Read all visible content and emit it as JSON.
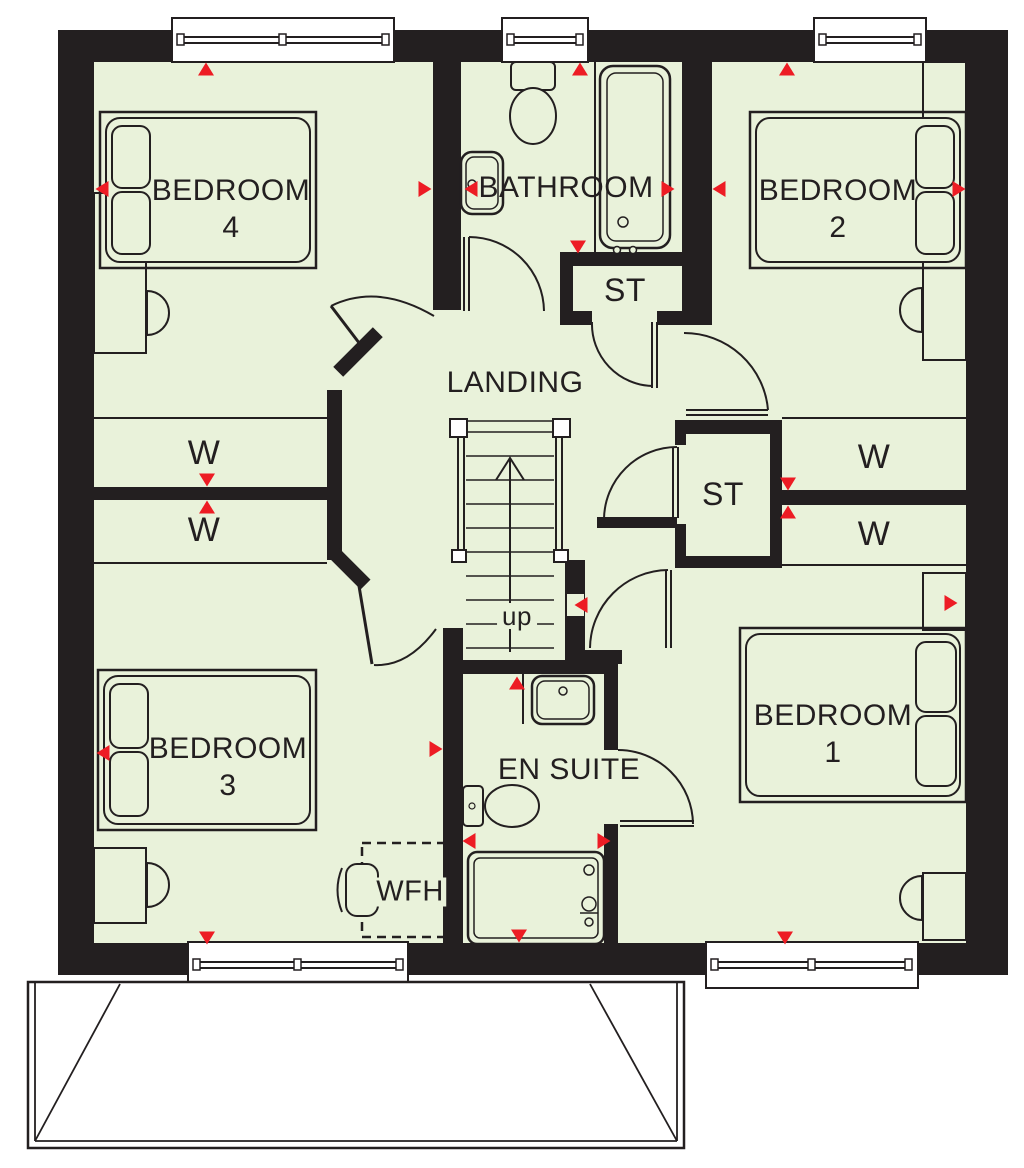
{
  "plan": {
    "title": "first-floor-plan",
    "colors": {
      "floor": "#e9f2da",
      "wall": "#231f20",
      "marker": "#ed1c24",
      "line": "#231f20"
    },
    "rooms": {
      "bedroom4": {
        "label": "BEDROOM",
        "number": "4"
      },
      "bathroom": {
        "label": "BATHROOM"
      },
      "bedroom2": {
        "label": "BEDROOM",
        "number": "2"
      },
      "storage_top": {
        "label": "ST"
      },
      "landing": {
        "label": "LANDING"
      },
      "storage_middle": {
        "label": "ST"
      },
      "bedroom3": {
        "label": "BEDROOM",
        "number": "3"
      },
      "ensuite": {
        "label": "EN SUITE"
      },
      "bedroom1": {
        "label": "BEDROOM",
        "number": "1"
      }
    },
    "wardrobes": {
      "left_top": "W",
      "left_bottom": "W",
      "right_top": "W",
      "right_bottom": "W"
    },
    "stairs": {
      "direction_label": "up"
    },
    "desk": {
      "label": "WFH"
    }
  }
}
